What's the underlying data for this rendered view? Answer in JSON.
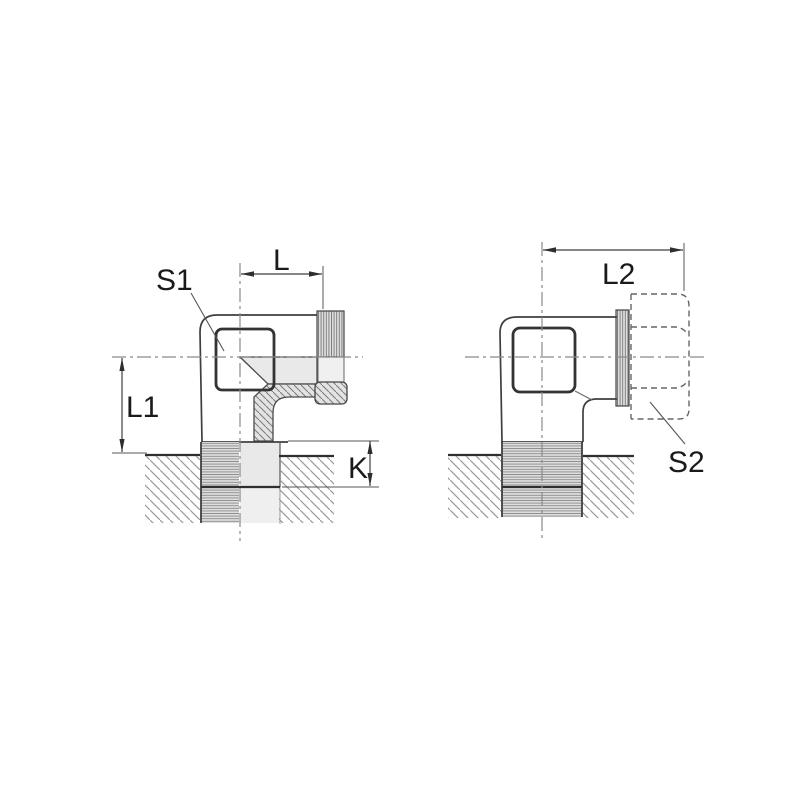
{
  "figure": {
    "title": "stud-elbow-fitting-dimension-drawing",
    "views": {
      "left": {
        "labels": {
          "s1": "S1",
          "l": "L",
          "l1": "L1",
          "k": "K"
        }
      },
      "right": {
        "labels": {
          "l2": "L2",
          "s2": "S2"
        }
      }
    },
    "colors": {
      "line": "#3f3f3f",
      "centerline": "#8a8a8a",
      "section_fill": "#e9e9e9",
      "hatch_line": "#999999",
      "label_text": "#1a1a1a",
      "background": "#ffffff"
    }
  }
}
